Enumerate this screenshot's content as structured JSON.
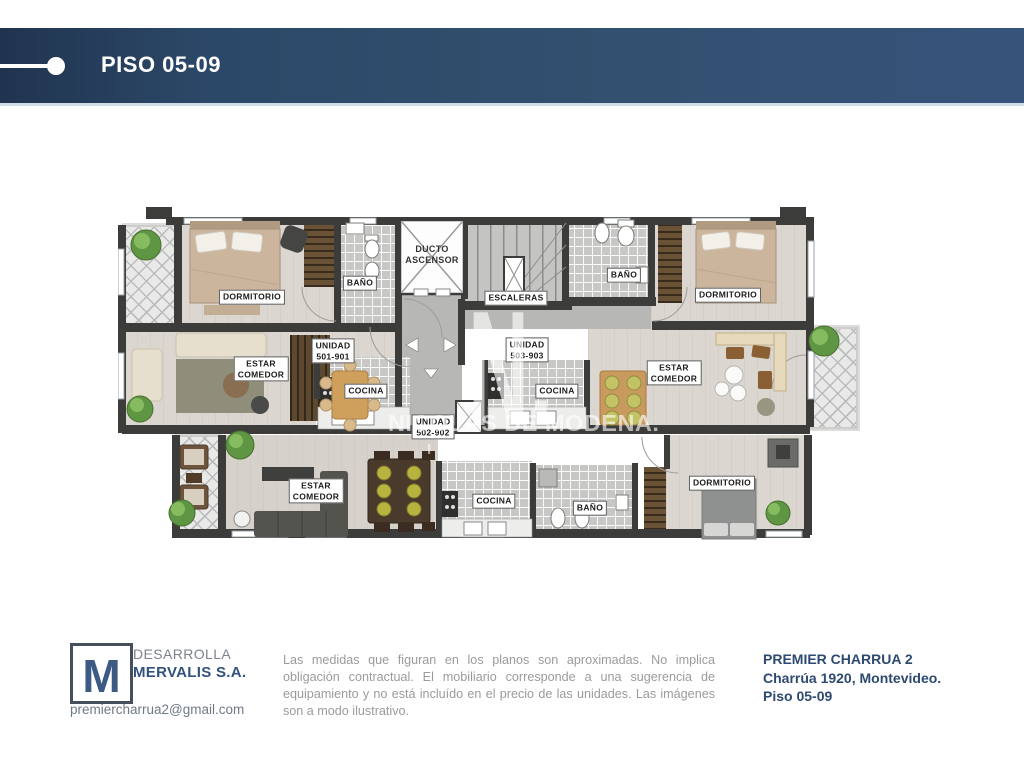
{
  "header": {
    "title": "PISO 05-09"
  },
  "plan": {
    "labels": {
      "dormitorio_501": "DORMITORIO",
      "bano_501": "BAÑO",
      "ducto": "DUCTO\nASCENSOR",
      "escaleras": "ESCALERAS",
      "bano_503": "BAÑO",
      "dormitorio_503": "DORMITORIO",
      "estar_501": "ESTAR\nCOMEDOR",
      "unidad_501": "UNIDAD\n501-901",
      "cocina_501": "COCINA",
      "unidad_503": "UNIDAD\n503-903",
      "cocina_503": "COCINA",
      "estar_503": "ESTAR\nCOMEDOR",
      "unidad_502": "UNIDAD\n502-902",
      "estar_502": "ESTAR\nCOMEDOR",
      "cocina_502": "COCINA",
      "bano_502": "BAÑO",
      "dormitorio_502": "DORMITORIO"
    },
    "watermark": {
      "monogram": "N.",
      "name": "NICOLÁS DE MODENA.",
      "tagline": "INMOBILIARIA"
    }
  },
  "footer": {
    "developer_monogram": "M",
    "developer_label": "DESARROLLA",
    "developer_name": "MERVALIS S.A.",
    "email": "premiercharrua2@gmail.com",
    "disclaimer": "Las medidas que figuran en los planos son aproximadas. No implica obligación contractual. El mobiliario corresponde a una sugerencia de equipamiento y no está incluído en el precio de las unidades. Las imágenes son a modo ilustrativo.",
    "project_name": "PREMIER CHARRUA 2",
    "project_address": "Charrúa 1920, Montevideo.",
    "project_floor": "Piso 05-09"
  },
  "colors": {
    "header_navy_dark": "#20344f",
    "header_navy": "#36547a",
    "brand_navy": "#2e4a70",
    "wall": "#3c3c3a",
    "floor": "#dbd7d0",
    "text_gray": "#9b9b9b"
  }
}
